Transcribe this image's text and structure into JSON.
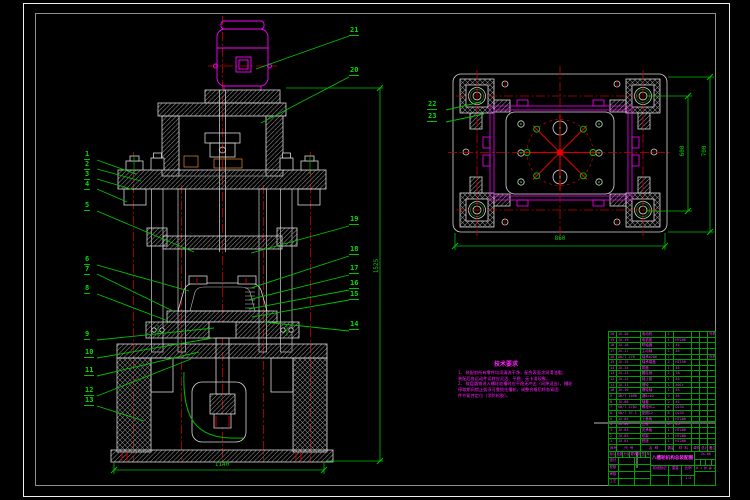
{
  "colors": {
    "green": "#00c000",
    "red": "#c80000",
    "magenta": "#ff00ff",
    "white": "#d8d8d8"
  },
  "part_labels": [
    {
      "t": "1",
      "x": 84,
      "y": 151
    },
    {
      "t": "2",
      "x": 84,
      "y": 161
    },
    {
      "t": "3",
      "x": 84,
      "y": 171
    },
    {
      "t": "4",
      "x": 84,
      "y": 181
    },
    {
      "t": "5",
      "x": 84,
      "y": 202
    },
    {
      "t": "6",
      "x": 84,
      "y": 256
    },
    {
      "t": "7",
      "x": 84,
      "y": 266
    },
    {
      "t": "8",
      "x": 84,
      "y": 285
    },
    {
      "t": "9",
      "x": 84,
      "y": 331
    },
    {
      "t": "10",
      "x": 84,
      "y": 349
    },
    {
      "t": "11",
      "x": 84,
      "y": 367
    },
    {
      "t": "12",
      "x": 84,
      "y": 387
    },
    {
      "t": "13",
      "x": 84,
      "y": 397
    },
    {
      "t": "14",
      "x": 349,
      "y": 321
    },
    {
      "t": "15",
      "x": 349,
      "y": 291
    },
    {
      "t": "16",
      "x": 349,
      "y": 280
    },
    {
      "t": "17",
      "x": 349,
      "y": 265
    },
    {
      "t": "18",
      "x": 349,
      "y": 246
    },
    {
      "t": "19",
      "x": 349,
      "y": 216
    },
    {
      "t": "20",
      "x": 349,
      "y": 67
    },
    {
      "t": "21",
      "x": 349,
      "y": 27
    },
    {
      "t": "22",
      "x": 427,
      "y": 101
    },
    {
      "t": "23",
      "x": 427,
      "y": 113
    }
  ],
  "dimensions": {
    "front_width": "1140",
    "front_height": "1525",
    "top_width": "860",
    "top_height_inner": "600",
    "top_height_outer": "700"
  },
  "tech_notes": {
    "title": "技术要求",
    "lines": [
      "1. 装配前所有零件均须清洗干净，配合表面涂润滑油脂；",
      "装配后各运动件运转应灵活、平稳，无卡滞现象。",
      "2. 拨盘圆销进入槽轮轮槽时应平稳无冲击（间隙适当），槽轮",
      "停歇期间锁止弧须可靠锁住槽轮，调整合格后将各紧固",
      "件拧紧并定位（涂防松胶）。"
    ]
  },
  "bom": {
    "header": [
      "序号",
      "代 号",
      "名 称",
      "数量",
      "材 料",
      "单件",
      "总计",
      "备注"
    ],
    "rows": [
      [
        "20",
        "JX-20",
        "电动机",
        "1",
        "",
        "",
        "",
        "外购"
      ],
      [
        "19",
        "JX-19",
        "电机座",
        "1",
        "HT200",
        "",
        "",
        ""
      ],
      [
        "18",
        "JX-18",
        "联轴器",
        "1",
        "45",
        "",
        "",
        ""
      ],
      [
        "17",
        "JX-17",
        "主动轴",
        "1",
        "45",
        "",
        "",
        ""
      ],
      [
        "16",
        "GB/T 276",
        "轴承6206",
        "2",
        "",
        "",
        "",
        "外购"
      ],
      [
        "15",
        "JX-15",
        "轴承端盖",
        "2",
        "HT150",
        "",
        "",
        ""
      ],
      [
        "14",
        "JX-14",
        "拨盘",
        "1",
        "45",
        "",
        "",
        ""
      ],
      [
        "13",
        "JX-13",
        "圆柱销",
        "2",
        "T8",
        "",
        "",
        ""
      ],
      [
        "12",
        "JX-12",
        "锁止弧",
        "1",
        "45",
        "",
        "",
        ""
      ],
      [
        "11",
        "JX-11",
        "槽轮",
        "1",
        "40Cr",
        "",
        "",
        ""
      ],
      [
        "10",
        "JX-10",
        "槽轮轴",
        "1",
        "45",
        "",
        "",
        ""
      ],
      [
        "9",
        "GB/T 1096",
        "键8×40",
        "2",
        "45",
        "",
        "",
        ""
      ],
      [
        "8",
        "JX-08",
        "轴套",
        "2",
        "45",
        "",
        "",
        ""
      ],
      [
        "7",
        "GB/T 5782",
        "螺栓M12",
        "8",
        "Q235",
        "",
        "",
        ""
      ],
      [
        "6",
        "GB/T 97.1",
        "垫圈12",
        "8",
        "Q235",
        "",
        "",
        ""
      ],
      [
        "5",
        "JX-05",
        "上盖板",
        "1",
        "HT200",
        "",
        "",
        ""
      ],
      [
        "4",
        "JX-04",
        "立柱",
        "4",
        "45",
        "",
        "",
        ""
      ],
      [
        "3",
        "JX-03",
        "支承板",
        "1",
        "HT200",
        "",
        "",
        ""
      ],
      [
        "2",
        "JX-02",
        "机架",
        "1",
        "HT200",
        "",
        "",
        ""
      ],
      [
        "1",
        "JX-01",
        "底座",
        "1",
        "HT200",
        "",
        "",
        ""
      ]
    ]
  },
  "title_block": {
    "title": "八槽轮机构总装配图",
    "rev_row": [
      "标记",
      "处数",
      "分区",
      "更改文件号",
      "签名",
      "年月日"
    ],
    "sign_rows": [
      [
        "设计",
        "",
        ""
      ],
      [
        "校核",
        "",
        ""
      ],
      [
        "审核",
        "",
        ""
      ],
      [
        "工艺",
        "",
        ""
      ]
    ],
    "stage_labels": [
      "阶段标记",
      "重量",
      "比例"
    ],
    "stage_values": [
      "",
      "",
      "1:2"
    ],
    "doc_no": "JX-00",
    "sheet": "共 1 张 第 1 张"
  }
}
